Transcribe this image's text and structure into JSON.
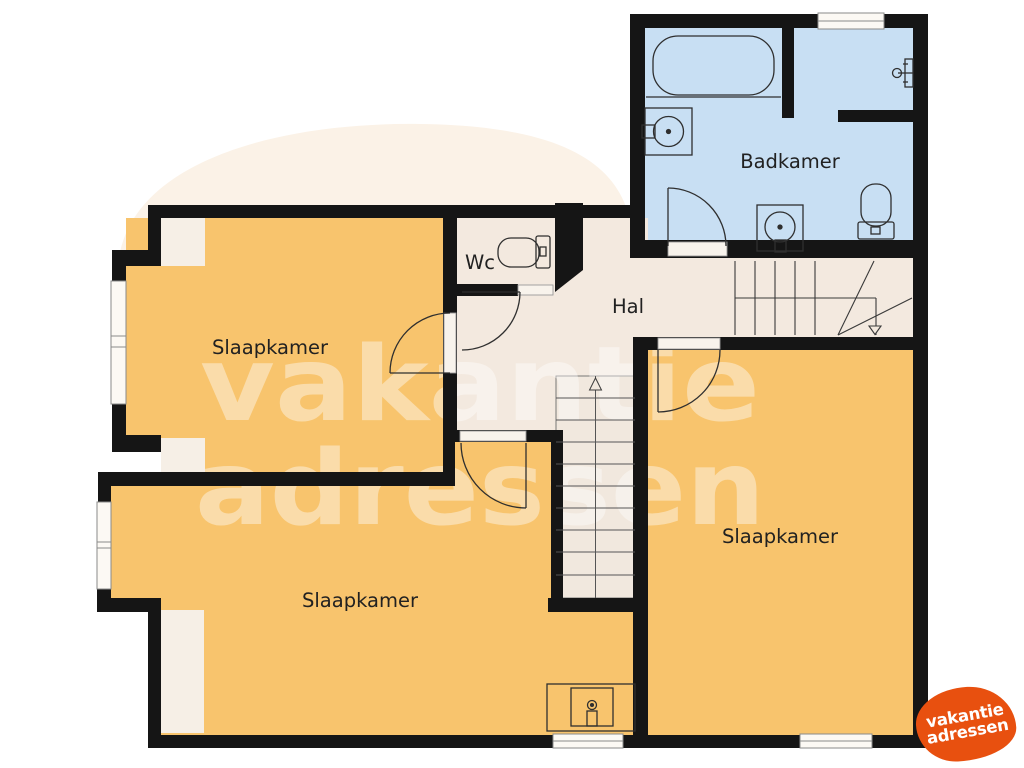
{
  "page": {
    "background": "#ffffff",
    "blob_color": "#fbf2e7"
  },
  "plan": {
    "colors": {
      "wall": "#151515",
      "bedroom_fill": "#f8c46d",
      "bathroom_fill": "#c8dff3",
      "floor_fill": "#f3e9df",
      "closet_fill": "#f6efe6",
      "window_fill": "#fcf9f4",
      "fixture_stroke": "#2f2f2f"
    },
    "rooms": [
      {
        "id": "badkamer",
        "label": "Badkamer"
      },
      {
        "id": "wc",
        "label": "Wc"
      },
      {
        "id": "hal",
        "label": "Hal"
      },
      {
        "id": "slaapkamer-links-boven",
        "label": "Slaapkamer"
      },
      {
        "id": "slaapkamer-links-onder",
        "label": "Slaapkamer"
      },
      {
        "id": "slaapkamer-rechts",
        "label": "Slaapkamer"
      }
    ],
    "fixtures": [
      "bathtub",
      "washbasin",
      "washbasin",
      "shower-tap",
      "toilet",
      "toilet",
      "sink-unit",
      "staircase-upper",
      "staircase-main",
      "stair-arrow-up",
      "stair-arrow-down"
    ]
  },
  "watermark": {
    "line1": "vakantie",
    "line2": "adressen"
  },
  "logo": {
    "line1": "vakantie",
    "line2": "adressen",
    "bg_color": "#e8500f",
    "text_color": "#ffffff"
  }
}
